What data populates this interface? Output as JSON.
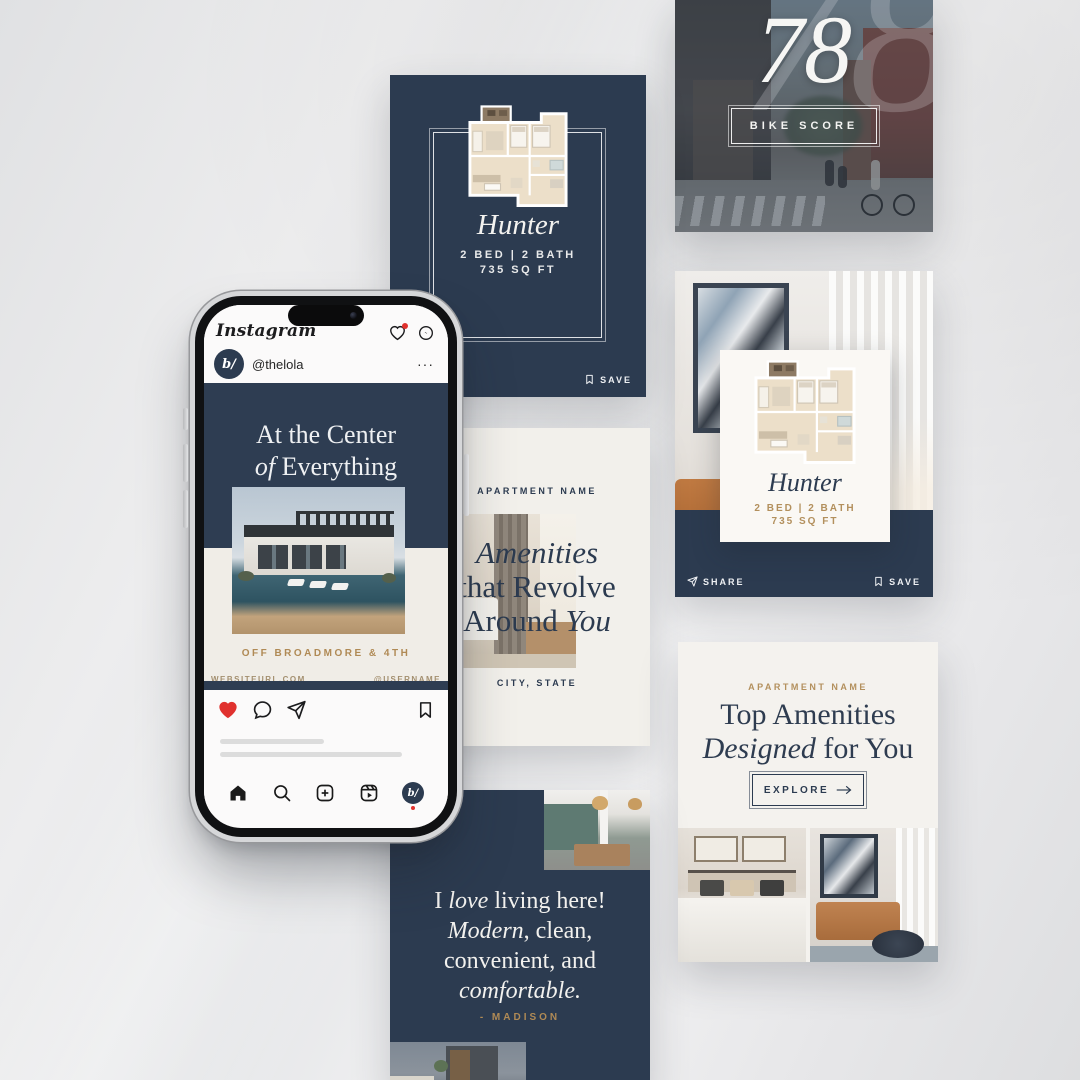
{
  "colors": {
    "navy": "#2c3b50",
    "gold": "#b08a55",
    "cream": "#f3f1ec",
    "heart_red": "#e0312e"
  },
  "phone": {
    "app_title": "Instagram",
    "post_header": {
      "avatar_monogram": "b/",
      "username": "@thelola",
      "more": "···"
    },
    "post": {
      "headline_line1": "At the Center",
      "headline_line2_italic": "of",
      "headline_line2_rest": " Everything",
      "caption": "OFF BROADMORE & 4TH",
      "footer_left": "WEBSITEURL.COM",
      "footer_right": "@USERNAME"
    },
    "nav_avatar_monogram": "b/"
  },
  "cards": {
    "floorplan_dark": {
      "title": "Hunter",
      "specs": "2 BED | 2 BATH",
      "area": "735 SQ FT",
      "save_label": "SAVE"
    },
    "bike": {
      "score": "78",
      "ghost_score": "78",
      "label": "BIKE SCORE"
    },
    "floorplan_overlay": {
      "title": "Hunter",
      "specs": "2 BED | 2 BATH",
      "area": "735 SQ FT",
      "share_label": "SHARE",
      "save_label": "SAVE"
    },
    "amenities": {
      "eyebrow": "APARTMENT NAME",
      "line1_italic": "Amenities",
      "line2": "that Revolve",
      "line3_start": "Around ",
      "line3_italic": "You",
      "footer": "CITY, STATE"
    },
    "top_amenities": {
      "eyebrow": "APARTMENT NAME",
      "line1": "Top Amenities",
      "line2_italic": "Designed",
      "line2_rest": " for You",
      "cta": "EXPLORE"
    },
    "testimonial": {
      "q1_start": "I ",
      "q1_italic": "love",
      "q1_end": " living here!",
      "q2_italic": "Modern",
      "q2_end": ", clean,",
      "q3": "convenient, and",
      "q4_italic": "comfortable.",
      "author": "- MADISON"
    }
  },
  "icons": {
    "header": [
      "heart-notification-icon",
      "messenger-icon"
    ],
    "post_actions": [
      "like-icon",
      "comment-icon",
      "send-icon",
      "bookmark-icon"
    ],
    "bottom_nav": [
      "home-icon",
      "search-icon",
      "create-icon",
      "reels-icon",
      "profile-avatar"
    ],
    "card_actions": [
      "share-icon",
      "save-bookmark-icon",
      "explore-arrow-icon"
    ]
  }
}
